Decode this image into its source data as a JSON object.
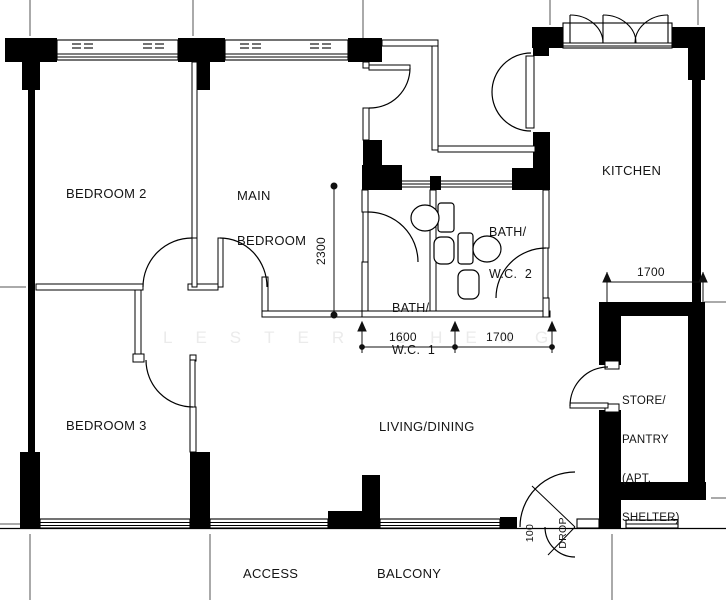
{
  "floorplan": {
    "rooms": {
      "bedroom2": {
        "label": "BEDROOM 2"
      },
      "main_bedroom": {
        "line1": "MAIN",
        "line2": "BEDROOM"
      },
      "kitchen": {
        "label": "KITCHEN"
      },
      "bath_wc_2": {
        "line1": "BATH/",
        "line2": "W.C.  2"
      },
      "bath_wc_1": {
        "line1": "BATH/",
        "line2": "W.C.  1"
      },
      "bedroom3": {
        "label": "BEDROOM 3"
      },
      "living_dining": {
        "label": "LIVING/DINING"
      },
      "store_pantry": {
        "line1": "STORE/",
        "line2": "PANTRY",
        "line3": "(APT.",
        "line4": "SHELTER)"
      },
      "access": {
        "label": "ACCESS"
      },
      "balcony": {
        "label": "BALCONY"
      }
    },
    "dimensions": {
      "bath_block_depth_mm": "2300",
      "bath1_width_mm": "1600",
      "bath2_width_mm": "1700",
      "store_width_mm": "1700",
      "balcony_drop": {
        "line1": "100",
        "line2": "DROP"
      }
    },
    "watermark": "LESTER CHENG",
    "colors": {
      "wall": "#000000",
      "background": "#ffffff",
      "gridline": "#555555",
      "watermark": "#ebebeb"
    }
  }
}
